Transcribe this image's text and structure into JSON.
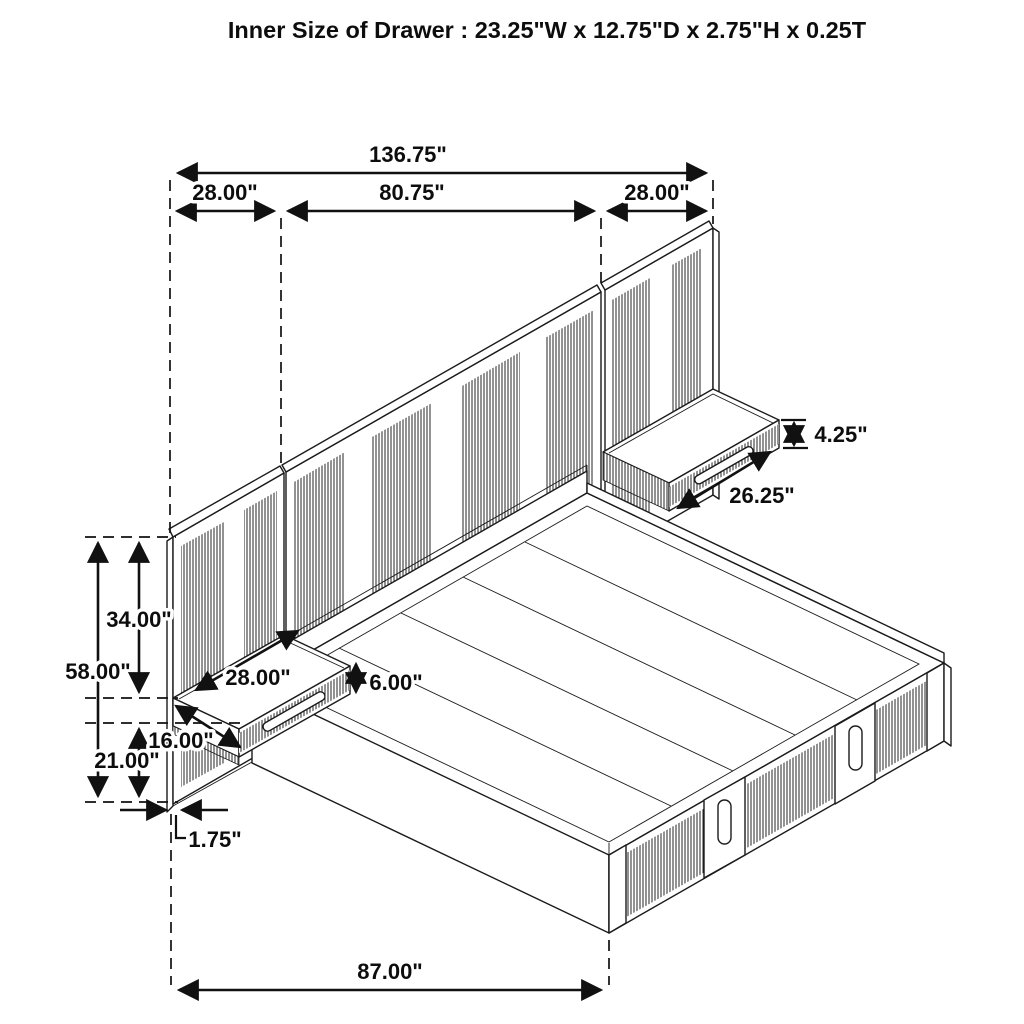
{
  "title": "Inner Size of Drawer : 23.25\"W x 12.75\"D x 2.75\"H x 0.25T",
  "drawing": "isometric wall-bed with panels, floating nightstand drawers and storage platform",
  "dimensions": {
    "overall_width": "136.75\"",
    "left_panel_width": "28.00\"",
    "center_panel_width": "80.75\"",
    "right_panel_width": "28.00\"",
    "panel_height": "58.00\"",
    "panel_top_to_nightstand": "34.00\"",
    "floor_to_nightstand": "21.00\"",
    "nightstand_width": "28.00\"",
    "nightstand_depth": "16.00\"",
    "nightstand_height": "6.00\"",
    "drawer_face_height": "4.25\"",
    "drawer_face_width": "26.25\"",
    "panel_thickness": "1.75\"",
    "platform_length": "87.00\""
  },
  "colors": {
    "line": "#1b1b1b",
    "background": "#ffffff"
  }
}
